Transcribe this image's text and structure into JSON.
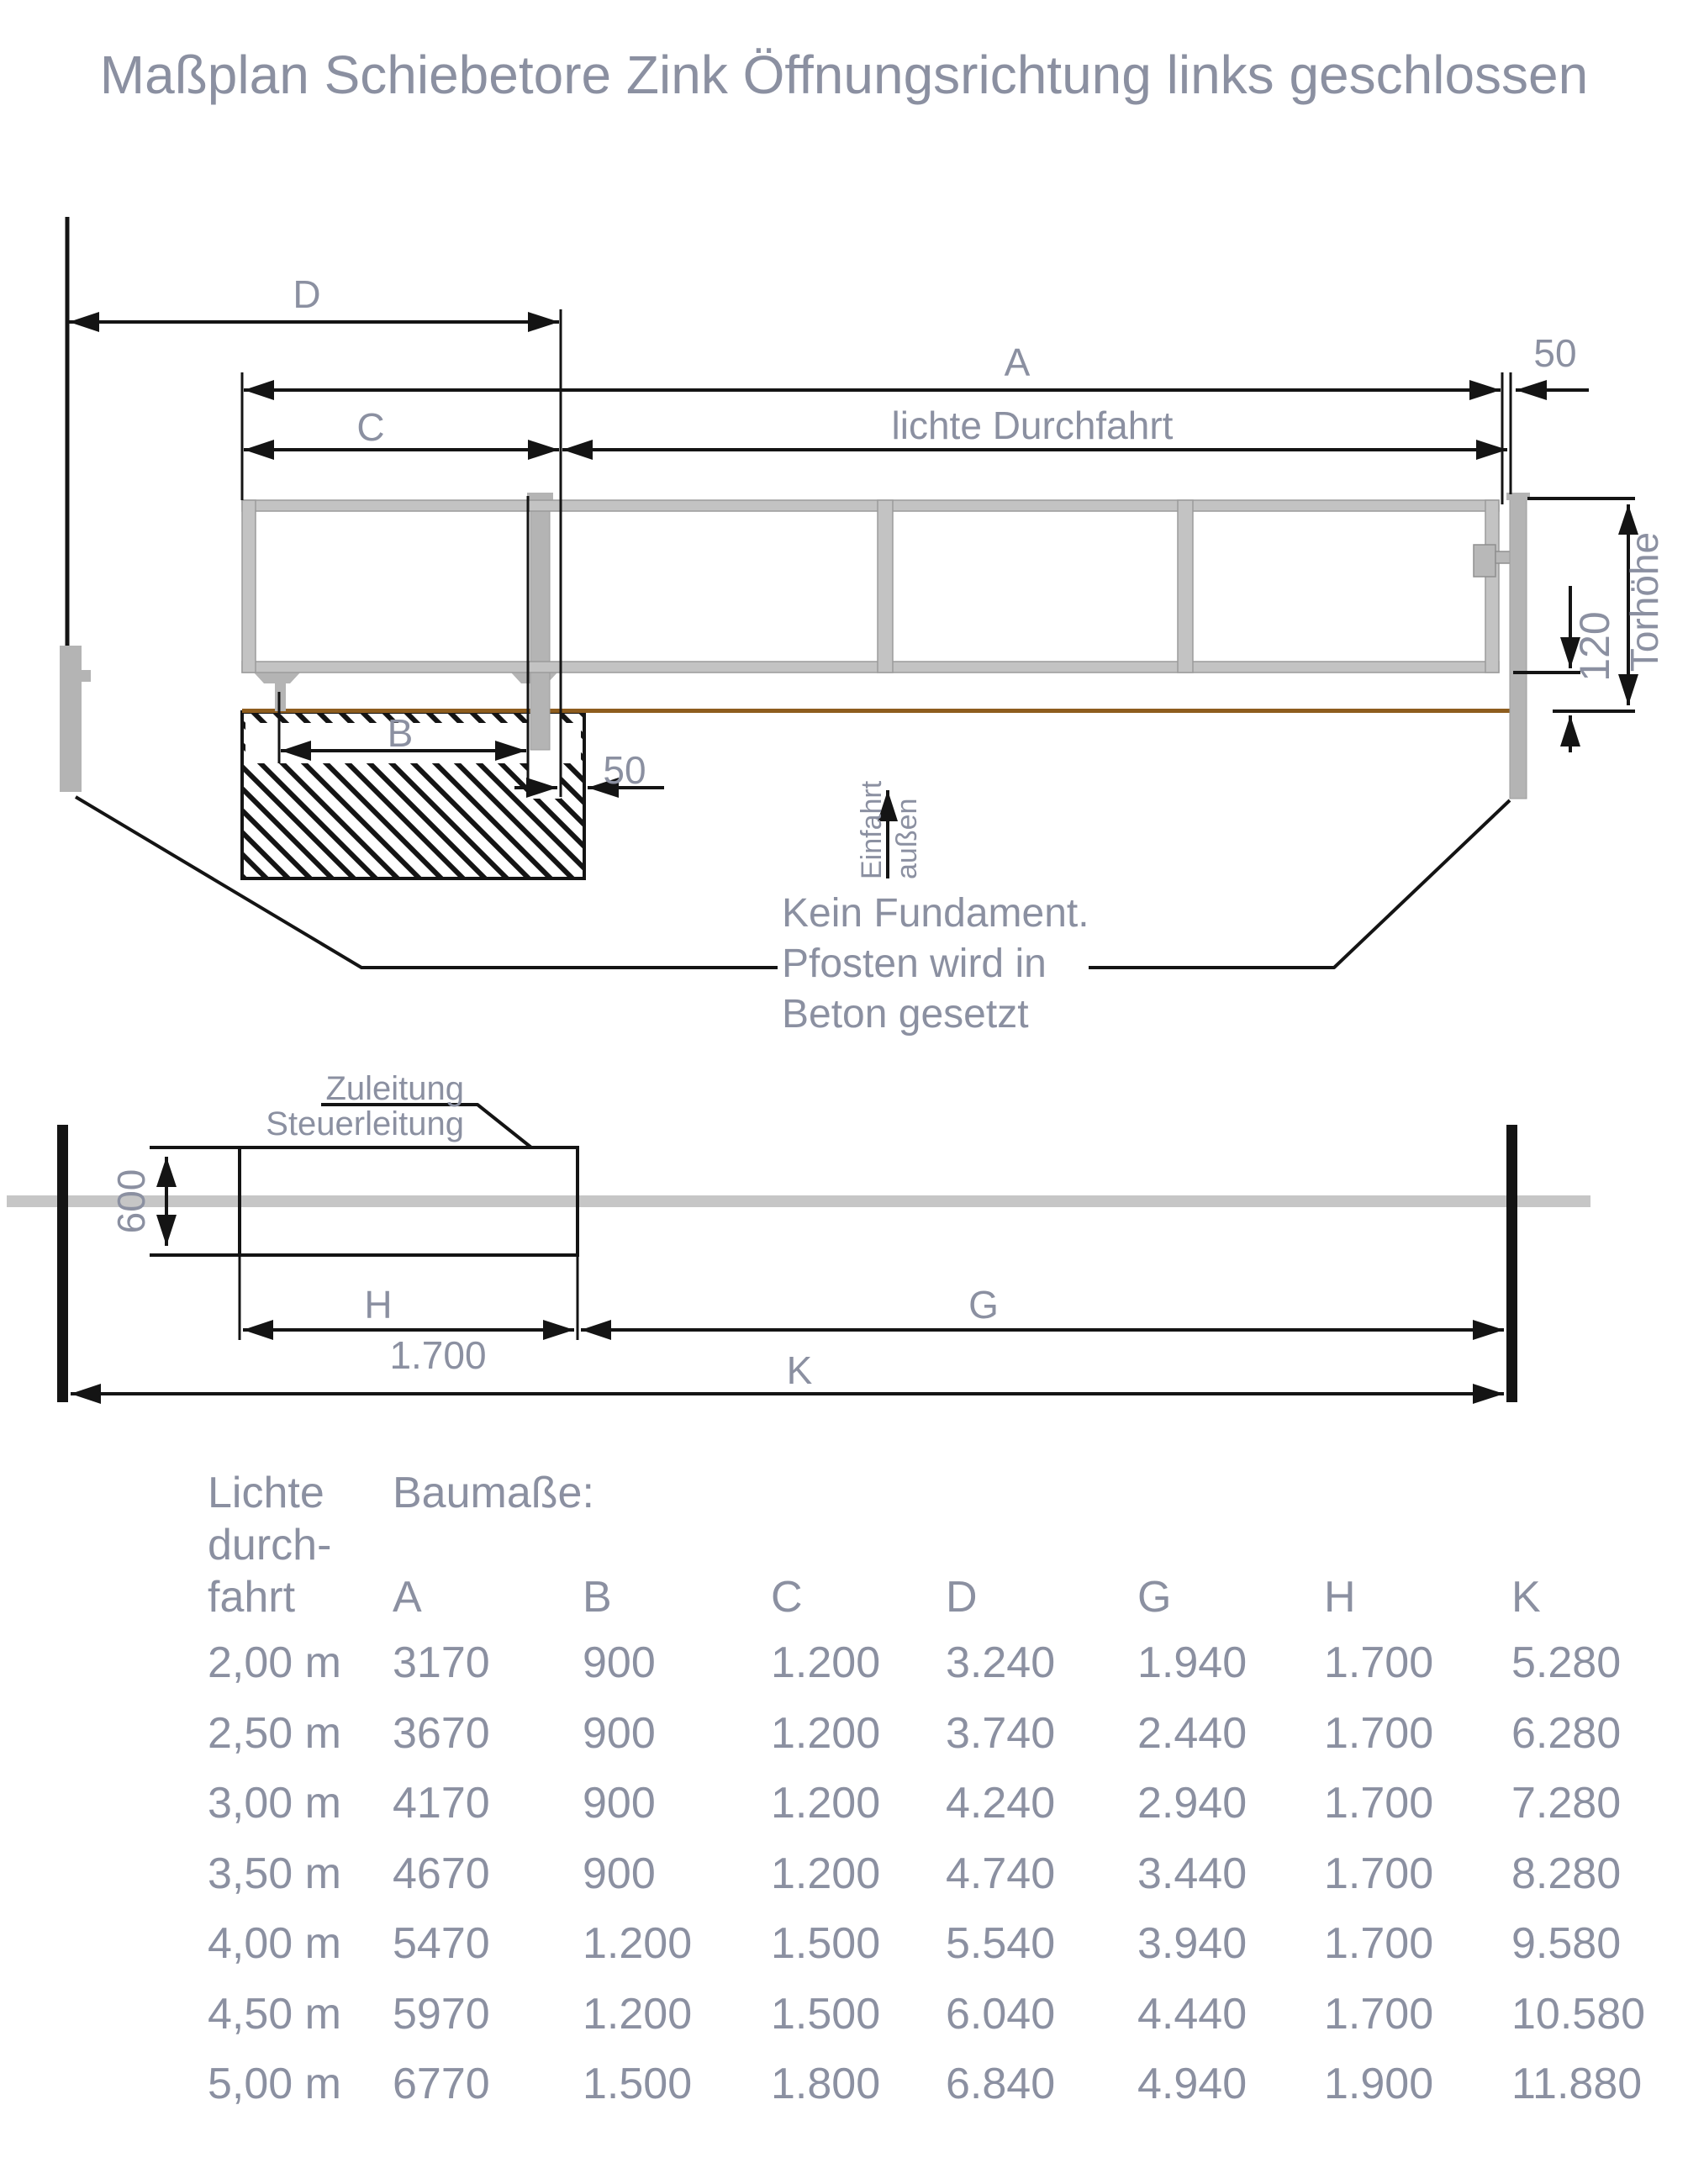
{
  "title": "Maßplan Schiebetore Zink Öffnungsrichtung links geschlossen",
  "colors": {
    "ink": "#8b90a1",
    "line": "#141414",
    "steel": "#c3c3c3",
    "steel_dark": "#b4b4b4",
    "steel_border": "#9b9b9b",
    "ground_brown": "#8e5d1e",
    "track_gray": "#c6c6c6"
  },
  "side_view": {
    "dim_d": "D",
    "dim_a": "A",
    "dim_gap_top": "50",
    "dim_c": "C",
    "dim_clear_passage": "lichte Durchfahrt",
    "dim_b": "B",
    "dim_gap_bottom": "50",
    "dim_gate_height": "Torhöhe",
    "dim_ground_clearance": "120",
    "entry_word_1": "Einfahrt",
    "entry_word_2": "außen",
    "note_line_1": "Kein Fundament.",
    "note_line_2": "Pfosten wird in",
    "note_line_3": "Beton gesetzt"
  },
  "plan_view": {
    "supply_line_1": "Zuleitung",
    "supply_line_2": "Steuerleitung",
    "dim_width": "600",
    "dim_h": "H",
    "dim_h_value": "1.700",
    "dim_g": "G",
    "dim_k": "K"
  },
  "table": {
    "row_header_lines": [
      "Lichte",
      "durch-",
      "fahrt"
    ],
    "group_header": "Baumaße:",
    "columns": [
      "A",
      "B",
      "C",
      "D",
      "G",
      "H",
      "K"
    ],
    "rows": [
      {
        "clearance": "2,00 m",
        "values": [
          "3170",
          "900",
          "1.200",
          "3.240",
          "1.940",
          "1.700",
          "5.280"
        ]
      },
      {
        "clearance": "2,50 m",
        "values": [
          "3670",
          "900",
          "1.200",
          "3.740",
          "2.440",
          "1.700",
          "6.280"
        ]
      },
      {
        "clearance": "3,00 m",
        "values": [
          "4170",
          "900",
          "1.200",
          "4.240",
          "2.940",
          "1.700",
          "7.280"
        ]
      },
      {
        "clearance": "3,50 m",
        "values": [
          "4670",
          "900",
          "1.200",
          "4.740",
          "3.440",
          "1.700",
          "8.280"
        ]
      },
      {
        "clearance": "4,00 m",
        "values": [
          "5470",
          "1.200",
          "1.500",
          "5.540",
          "3.940",
          "1.700",
          "9.580"
        ]
      },
      {
        "clearance": "4,50 m",
        "values": [
          "5970",
          "1.200",
          "1.500",
          "6.040",
          "4.440",
          "1.700",
          "10.580"
        ]
      },
      {
        "clearance": "5,00 m",
        "values": [
          "6770",
          "1.500",
          "1.800",
          "6.840",
          "4.940",
          "1.900",
          "11.880"
        ]
      }
    ]
  }
}
